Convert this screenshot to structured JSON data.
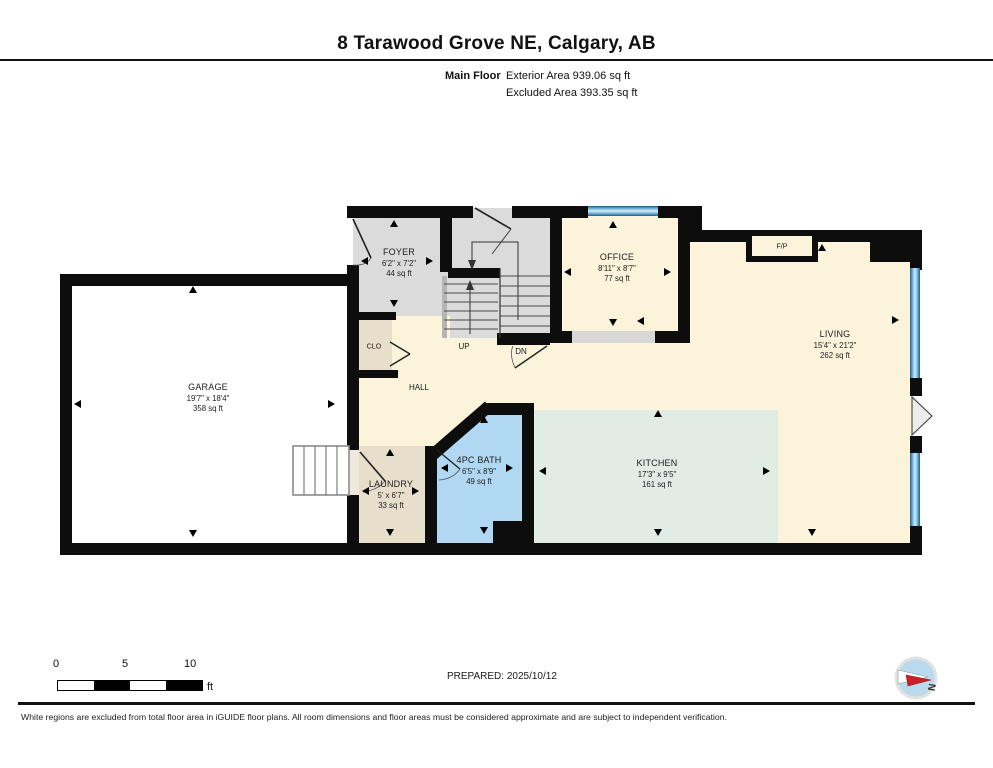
{
  "header": {
    "title": "8 Tarawood Grove NE, Calgary, AB",
    "floor_label": "Main Floor",
    "exterior_area": "Exterior Area 939.06 sq ft",
    "excluded_area": "Excluded Area 393.35 sq ft"
  },
  "rooms": {
    "foyer": {
      "name": "FOYER",
      "dims": "6'2\" x 7'2\"",
      "area": "44 sq ft"
    },
    "office": {
      "name": "OFFICE",
      "dims": "8'11\" x 8'7\"",
      "area": "77 sq ft"
    },
    "living": {
      "name": "LIVING",
      "dims": "15'4\" x 21'2\"",
      "area": "262 sq ft"
    },
    "garage": {
      "name": "GARAGE",
      "dims": "19'7\" x 18'4\"",
      "area": "358 sq ft"
    },
    "laundry": {
      "name": "LAUNDRY",
      "dims": "5' x 6'7\"",
      "area": "33 sq ft"
    },
    "bath": {
      "name": "4PC BATH",
      "dims": "6'5\" x 8'9\"",
      "area": "49 sq ft"
    },
    "kitchen": {
      "name": "KITCHEN",
      "dims": "17'3\" x 9'5\"",
      "area": "161 sq ft"
    }
  },
  "labels": {
    "closet": "CLO",
    "hall": "HALL",
    "up": "UP",
    "down": "DN",
    "fireplace": "F/P"
  },
  "scale_bar": {
    "tick_0": "0",
    "tick_5": "5",
    "tick_10": "10",
    "unit": "ft"
  },
  "prepared": "PREPARED: 2025/10/12",
  "compass": {
    "north": "N"
  },
  "footer": {
    "disclaimer": "White regions are excluded from total floor area in iGUIDE floor plans. All room dimensions and floor areas must be considered approximate and are subject to independent verification."
  },
  "colors": {
    "wall": "#0d0d0d",
    "floor_cream": "#FBF4DB",
    "floor_gray": "#DBDBDB",
    "floor_tan": "#E7DECB",
    "bath_blue": "#B0D8F2",
    "kitchen_mint": "#E1ECE5",
    "excluded_white": "#FFFFFF",
    "window_blue": "#5EA9D4"
  }
}
